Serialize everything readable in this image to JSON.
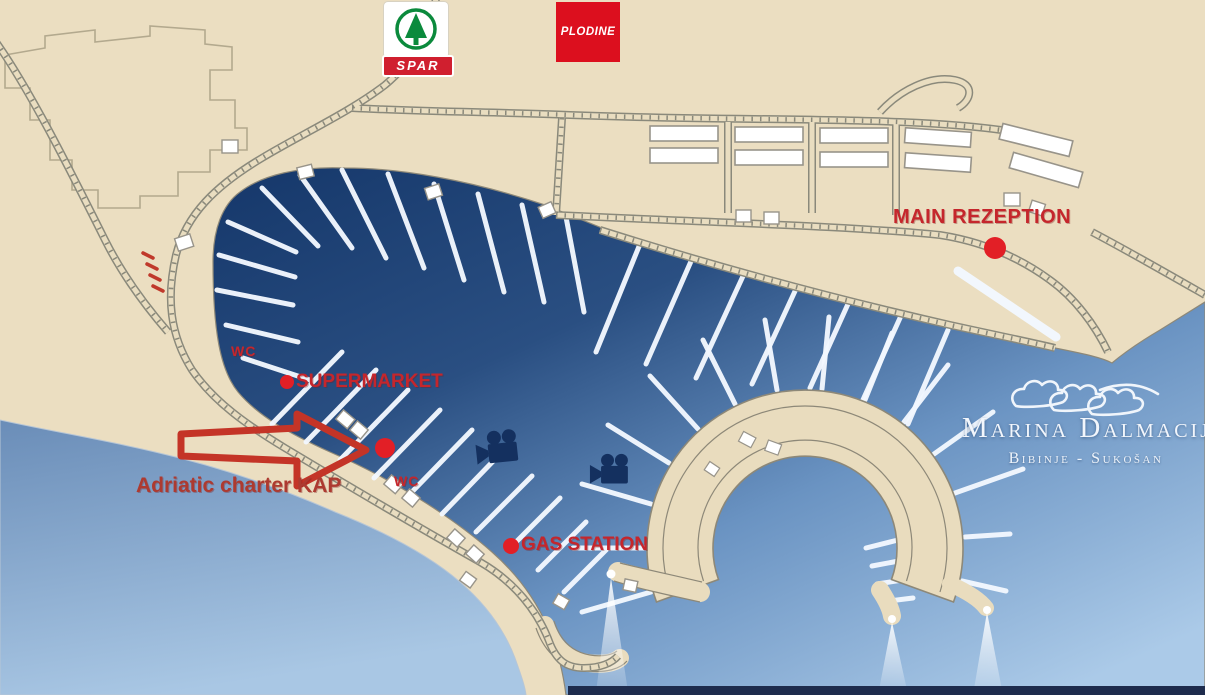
{
  "map": {
    "labels": {
      "main_reception": "MAIN REZEPTION",
      "supermarket": "SUPERMARKET",
      "gas_station": "GAS STATION",
      "charter": "Adriatic charter KAP",
      "wc_upper": "WC",
      "wc_lower": "WC"
    },
    "brand": {
      "marina_name": "Marina Dalmacija",
      "marina_subtitle": "Bibinje - Sukošan",
      "spar": "SPAR",
      "plodine": "PLODINE"
    },
    "icons": {
      "camera_west": "video-camera",
      "camera_east": "video-camera",
      "arrow": "red-outline-arrow-right",
      "waves_logo": "marina-waves",
      "lights": "harbor-light-beam"
    },
    "colors": {
      "land": "#ebdec1",
      "water_dark": "#16386b",
      "water_light": "#aac9e6",
      "label_red": "#c5262c",
      "marker_red": "#e21f26",
      "camera_navy": "#14305f",
      "spar_green": "#0b8a3c",
      "logo_red": "#d01f2f"
    }
  }
}
